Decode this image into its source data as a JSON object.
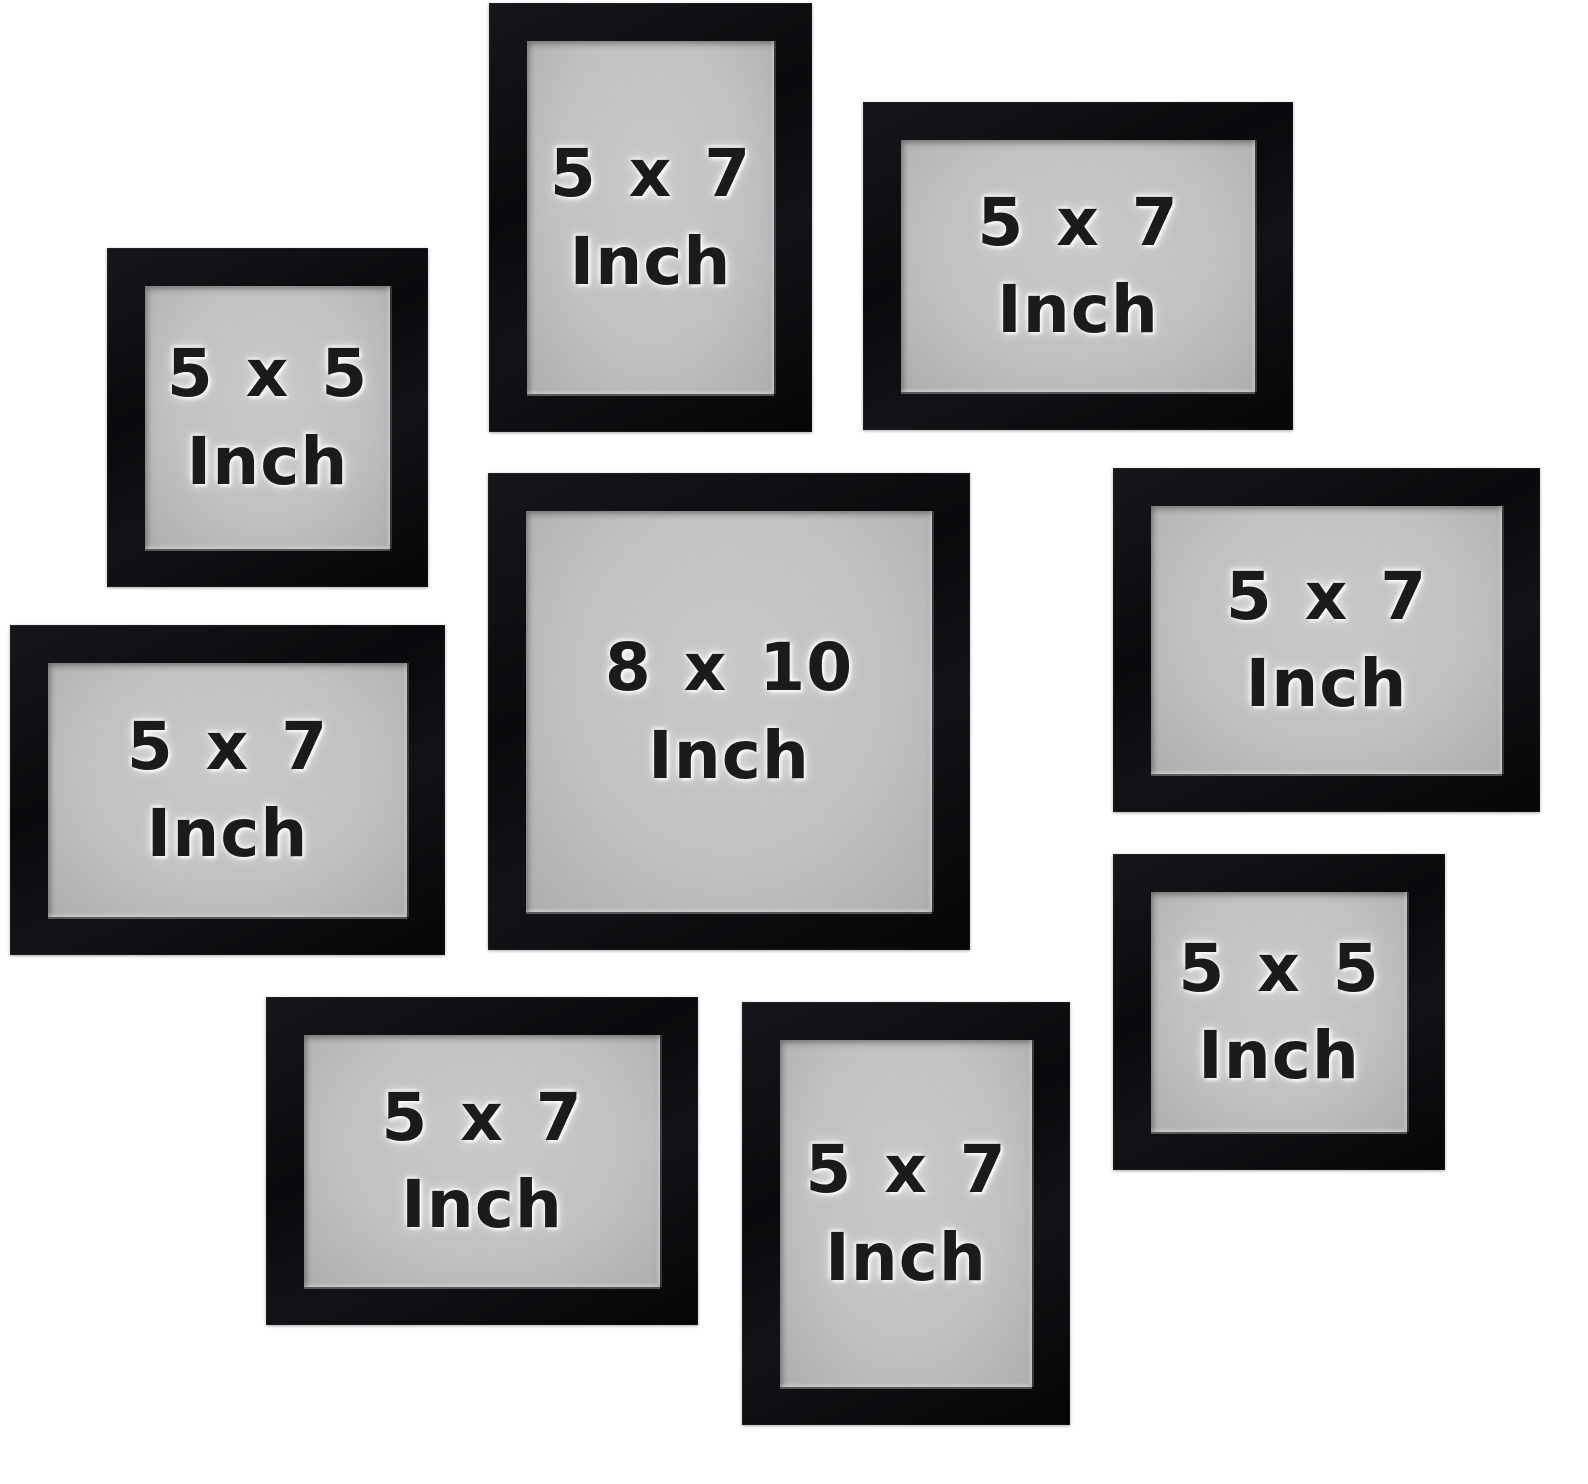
{
  "product": {
    "background": "#ffffff"
  },
  "colors": {
    "frame_black": "#0c0c0f",
    "mat_gray": "#c2c2c2",
    "label_text": "#1b1b1b"
  },
  "frames": [
    {
      "size": "5 x 5",
      "unit": "Inch"
    },
    {
      "size": "5 x 7",
      "unit": "Inch"
    },
    {
      "size": "5 x 7",
      "unit": "Inch"
    },
    {
      "size": "5 x 7",
      "unit": "Inch"
    },
    {
      "size": "8 x 10",
      "unit": "Inch"
    },
    {
      "size": "5 x 7",
      "unit": "Inch"
    },
    {
      "size": "5 x 5",
      "unit": "Inch"
    },
    {
      "size": "5 x 7",
      "unit": "Inch"
    },
    {
      "size": "5 x 7",
      "unit": "Inch"
    }
  ]
}
